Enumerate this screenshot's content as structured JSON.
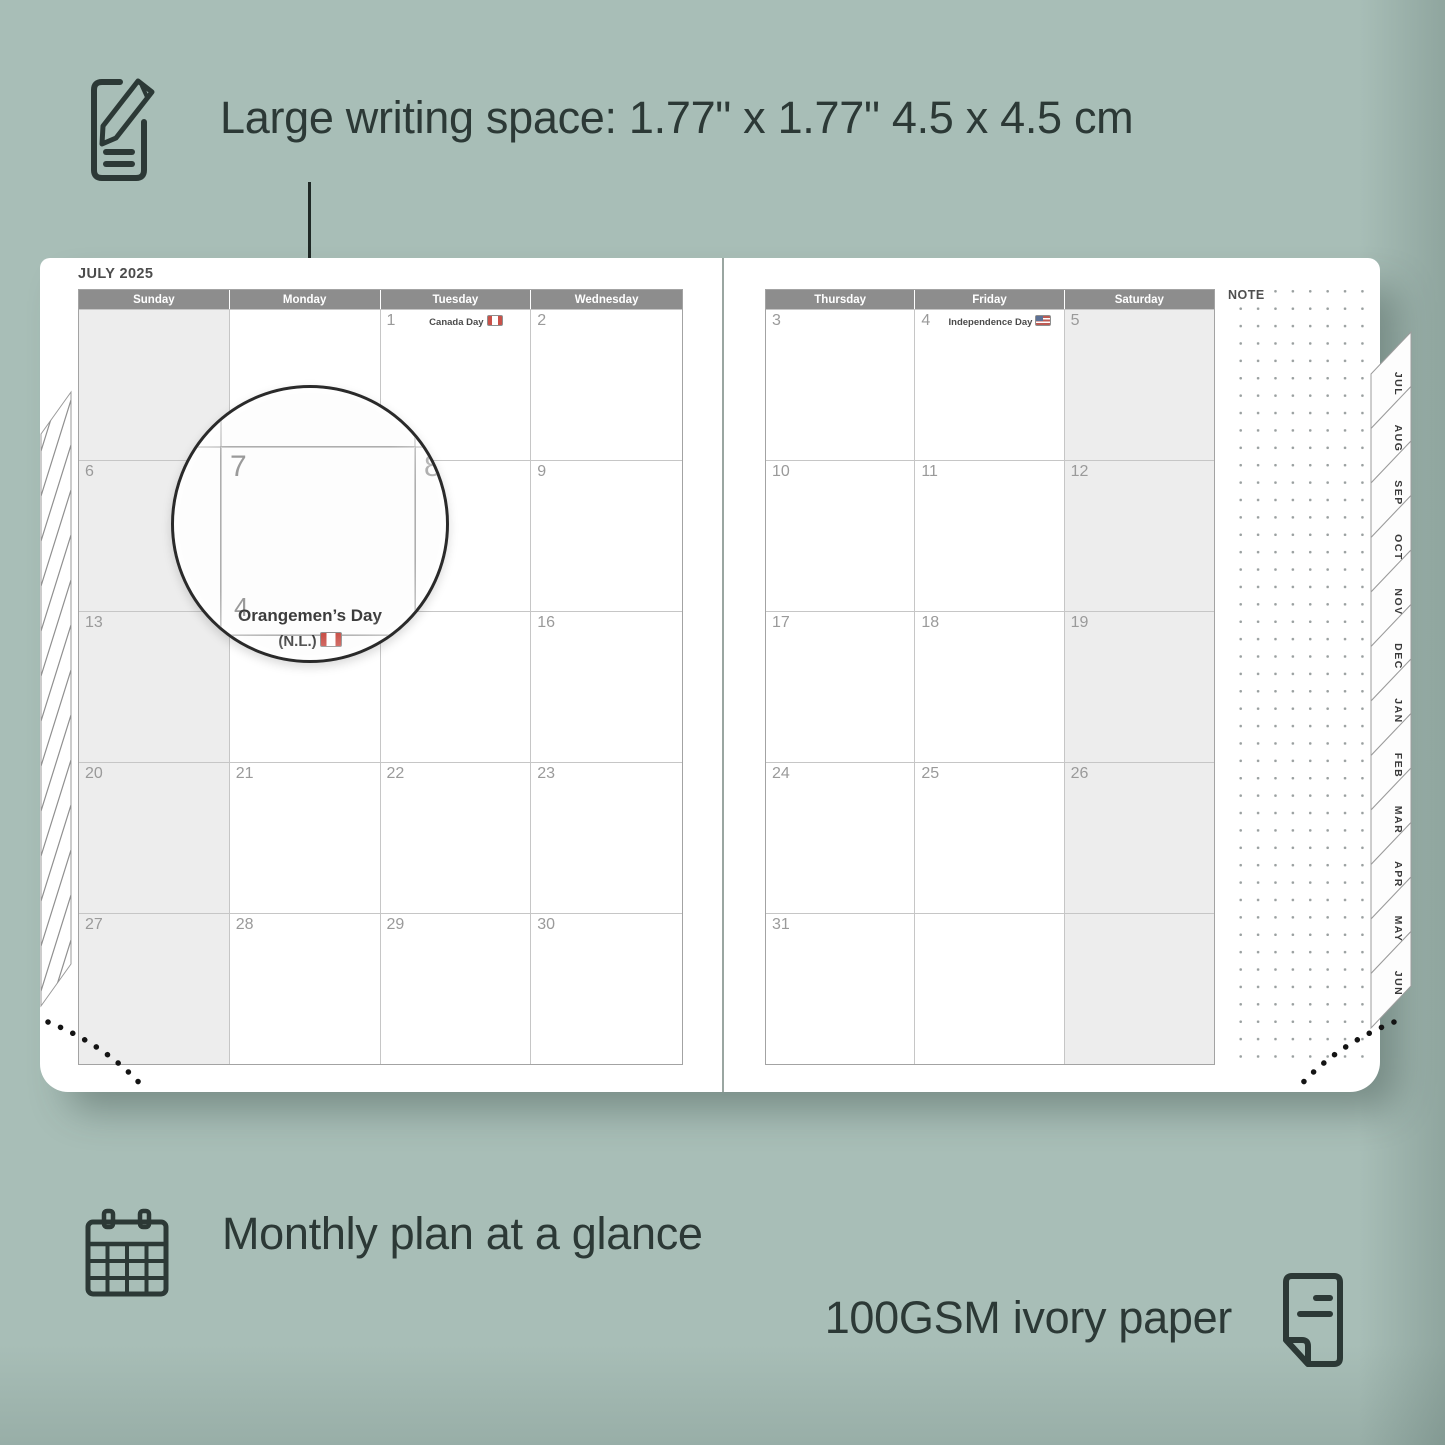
{
  "colors": {
    "background": "#a8beb7",
    "ink": "#2c3936",
    "header_bar": "#8d8d8d",
    "weekend_shade": "#ededed",
    "grid_line": "#c6c6c6",
    "date_number": "#9a9a9a"
  },
  "top_annotation": {
    "icon": "pencil-note-icon",
    "text": "Large writing space: 1.77\" x 1.77\" 4.5 x 4.5 cm"
  },
  "planner": {
    "title": "JULY 2025",
    "note_label": "NOTE",
    "left_day_headers": [
      "Sunday",
      "Monday",
      "Tuesday",
      "Wednesday"
    ],
    "right_day_headers": [
      "Thursday",
      "Friday",
      "Saturday"
    ],
    "left_weeks": [
      [
        {
          "d": ""
        },
        {
          "d": ""
        },
        {
          "d": "1",
          "holiday": "Canada Day",
          "flag": "ca"
        },
        {
          "d": "2"
        }
      ],
      [
        {
          "d": "6"
        },
        {
          "d": "7"
        },
        {
          "d": "8"
        },
        {
          "d": "9"
        }
      ],
      [
        {
          "d": "13"
        },
        {
          "d": "14",
          "holiday": "Orangemen’s Day",
          "holiday2": "(N.L.)",
          "flag": "ca"
        },
        {
          "d": "15"
        },
        {
          "d": "16"
        }
      ],
      [
        {
          "d": "20"
        },
        {
          "d": "21"
        },
        {
          "d": "22"
        },
        {
          "d": "23"
        }
      ],
      [
        {
          "d": "27"
        },
        {
          "d": "28"
        },
        {
          "d": "29"
        },
        {
          "d": "30"
        }
      ]
    ],
    "right_weeks": [
      [
        {
          "d": "3"
        },
        {
          "d": "4",
          "holiday": "Independence Day",
          "flag": "us"
        },
        {
          "d": "5"
        }
      ],
      [
        {
          "d": "10"
        },
        {
          "d": "11"
        },
        {
          "d": "12"
        }
      ],
      [
        {
          "d": "17"
        },
        {
          "d": "18"
        },
        {
          "d": "19"
        }
      ],
      [
        {
          "d": "24"
        },
        {
          "d": "25"
        },
        {
          "d": "26"
        }
      ],
      [
        {
          "d": "31"
        },
        {
          "d": ""
        },
        {
          "d": ""
        }
      ]
    ],
    "month_tabs": [
      "JUL",
      "AUG",
      "SEP",
      "OCT",
      "NOV",
      "DEC",
      "JAN",
      "FEB",
      "MAR",
      "APR",
      "MAY",
      "JUN"
    ]
  },
  "magnifier": {
    "day": "7",
    "adjacent_day": "8",
    "partial_day": "4",
    "holiday_line1": "Orangemen’s Day",
    "holiday_line2": "(N.L.)",
    "flag": "ca"
  },
  "bottom_annotations": {
    "monthly_icon": "calendar-grid-icon",
    "monthly": "Monthly plan at a glance",
    "paper": "100GSM ivory paper",
    "paper_icon": "paper-sheet-icon"
  }
}
